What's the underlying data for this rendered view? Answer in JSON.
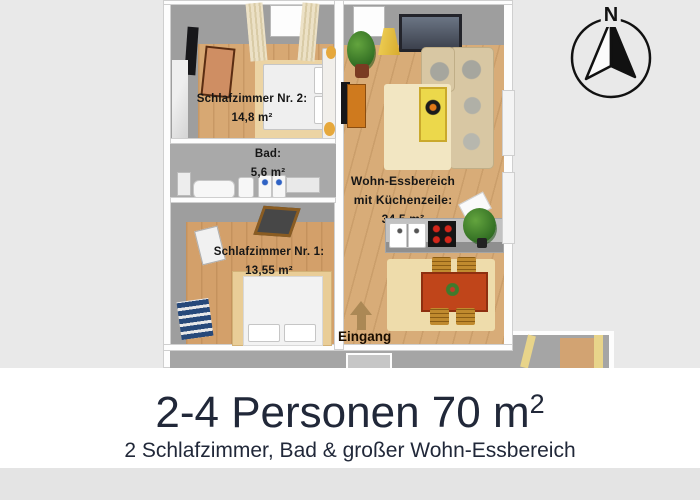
{
  "plan": {
    "compass": {
      "north_label": "N"
    },
    "rooms": {
      "bedroom2": {
        "name": "Schlafzimmer Nr. 2:",
        "area": "14,8 m²"
      },
      "bath": {
        "name": "Bad:",
        "area": "5,6 m²"
      },
      "bedroom1": {
        "name": "Schlafzimmer Nr. 1:",
        "area": "13,55 m²"
      },
      "living": {
        "name_line1": "Wohn-Essbereich",
        "name_line2": "mit Küchenzeile:",
        "area": "34,5 m²"
      }
    },
    "entrance_label": "Eingang"
  },
  "banner": {
    "title_main": "2-4 Personen 70 m",
    "title_superscript": "2",
    "subtitle": "2 Schlafzimmer, Bad & großer Wohn-Essbereich"
  },
  "colors": {
    "background": "#e9e9e9",
    "banner_background": "#ffffff",
    "banner_text": "#212839",
    "wall_gray": "#9e9e9e",
    "wood_floor": "#d7a873",
    "dining_table_red": "#c0451a",
    "label_text": "#161616"
  }
}
